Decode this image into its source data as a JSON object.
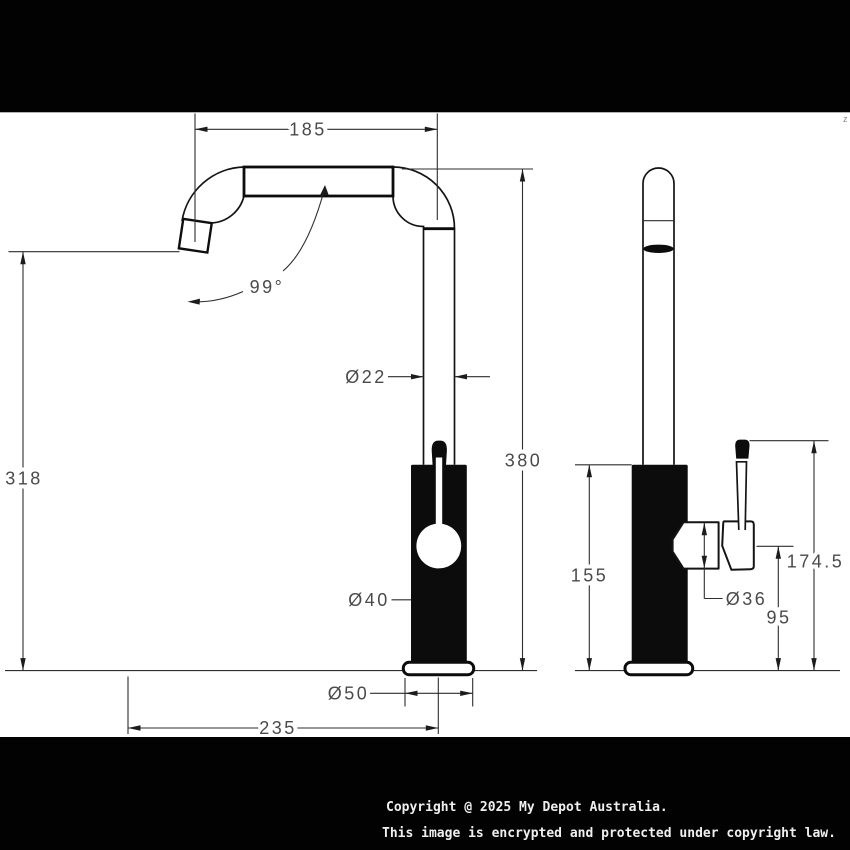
{
  "watermark": {
    "line1": "Copyright @ 2025 My Depot Australia.",
    "line2": "This image is encrypted and protected under copyright law."
  },
  "corner_mark": "z",
  "front_view": {
    "spout_reach": "185",
    "spout_angle": "99°",
    "spout_tube_diameter": "Ø22",
    "spout_height": "380",
    "outlet_height": "318",
    "body_diameter": "Ø40",
    "base_diameter": "Ø50",
    "total_reach": "235"
  },
  "side_view": {
    "body_height": "155",
    "handle_diameter": "Ø36",
    "handle_lower_height": "95",
    "handle_top_height": "174.5"
  }
}
